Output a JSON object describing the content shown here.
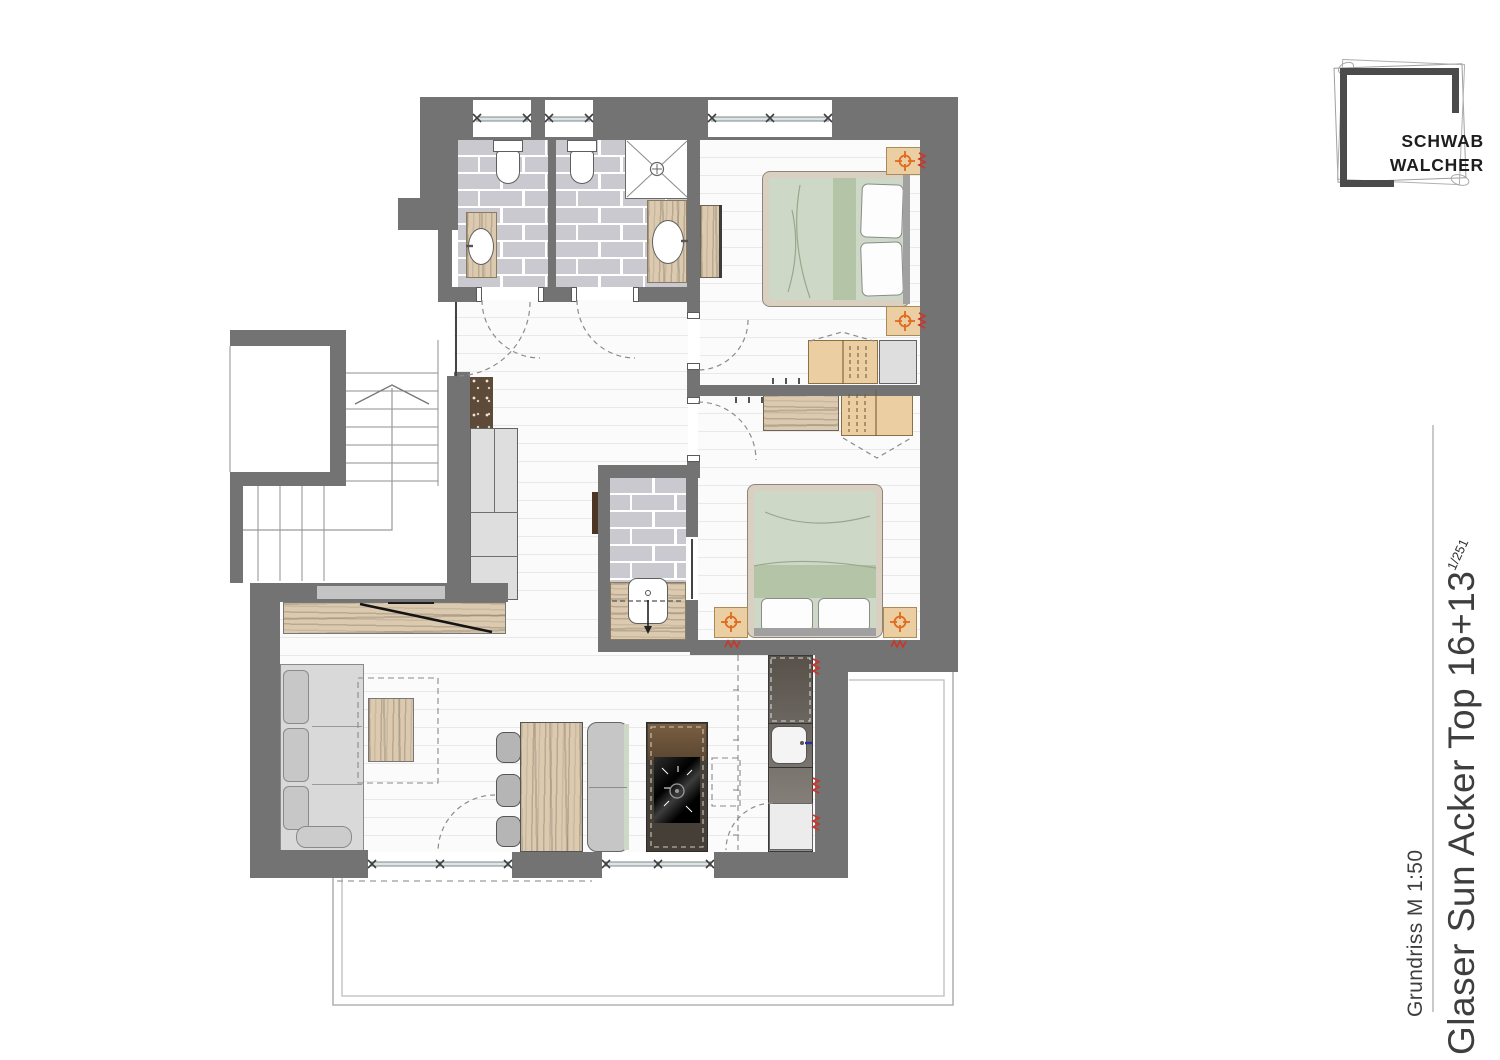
{
  "logo": {
    "line1": "SCHWAB",
    "line2": "WALCHER"
  },
  "title_block": {
    "project_title": "Glaser Sun Acker Top 16+13",
    "revision_overlay": "1/251",
    "drawing_label": "Grundriss M 1:50"
  },
  "colors": {
    "wall": "#737373",
    "tile": "#c9c9cf",
    "plankline": "#e9e9e9",
    "wood": "#dccab0",
    "sage": "#cdd9c6",
    "sageband": "#b4c4a6",
    "bedframe": "#d9d0c1",
    "stand": "#ebcfa3",
    "accent": "#e06a1e",
    "red": "#cc3526",
    "cab": "#dedede",
    "counter": "#463f37",
    "ink": "#3e3e3e"
  }
}
